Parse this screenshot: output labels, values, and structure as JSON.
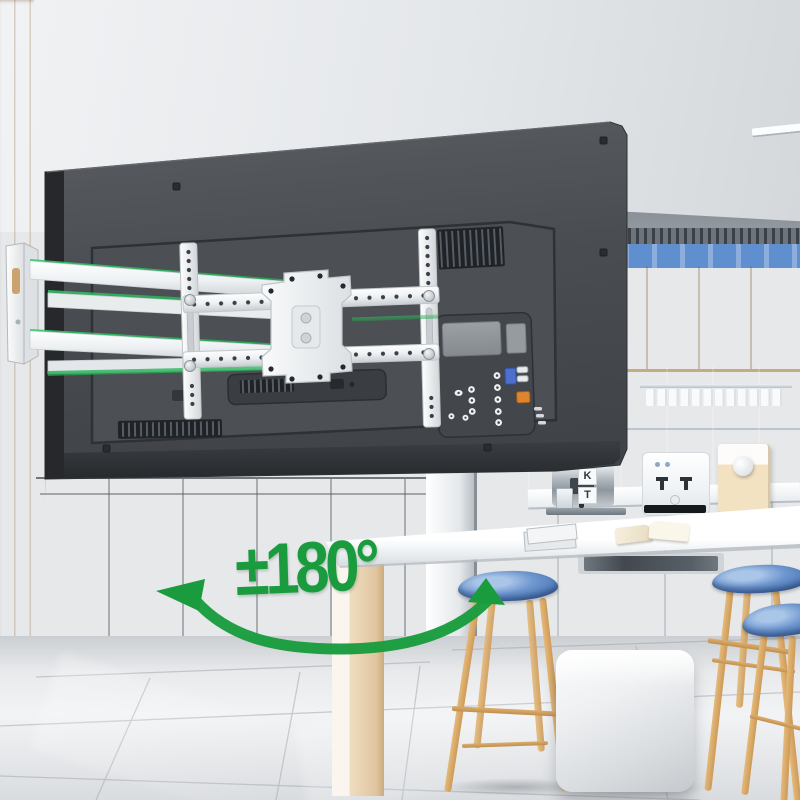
{
  "annotation": {
    "swivel_range_label": "±180°",
    "accent_color": "#1a9c3e"
  },
  "decor": {
    "block_letter_top": "K",
    "block_letter_bottom": "T"
  },
  "palette": {
    "accent_green": "#1a9c3e",
    "tv_back_gray": "#4b4e52",
    "backsplash_blue": "#7ea9dc",
    "cabinet_cream": "#f2dfbd",
    "wood_wall_tan": "#e7c79c",
    "mount_white": "#f4f6f7",
    "stool_seat_blue": "#5e87c3",
    "stool_leg_wood": "#d8a763"
  }
}
